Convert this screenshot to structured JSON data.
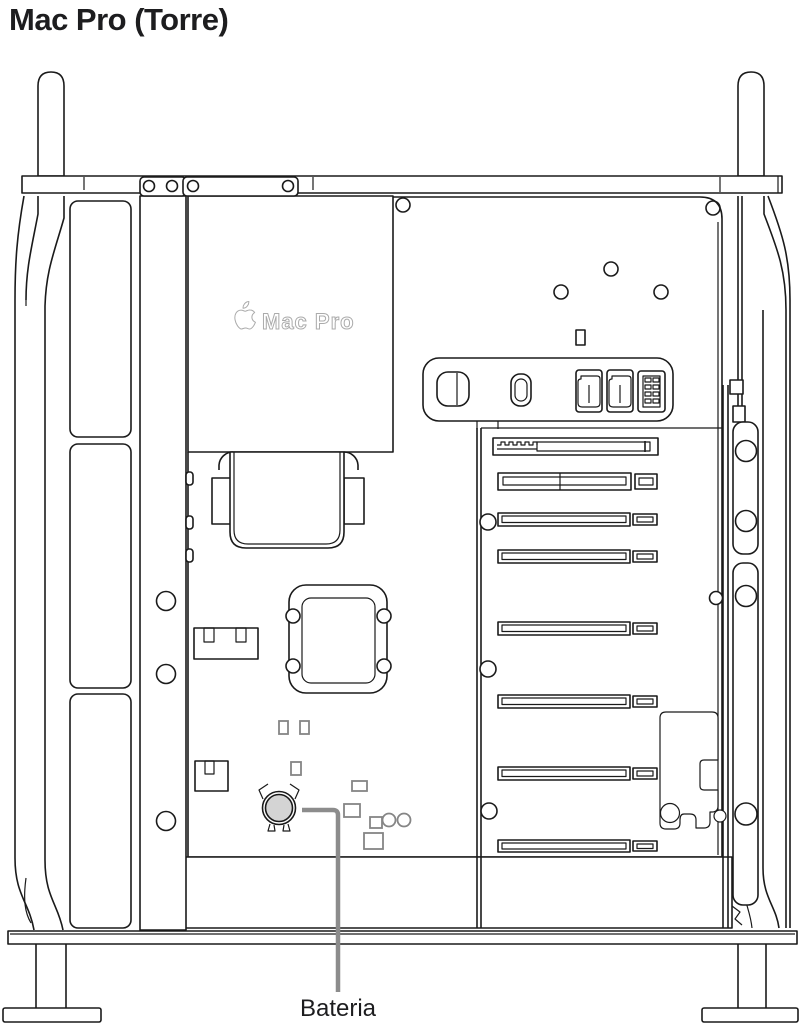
{
  "title": "Mac Pro (Torre)",
  "illustration": {
    "description": "Side view of an open Mac Pro tower showing internal components",
    "device_label": "Mac Pro",
    "callout": {
      "label": "Bateria",
      "target": "coin-cell-battery"
    }
  },
  "icons": {
    "apple_logo": "apple-logo-icon"
  },
  "colors": {
    "background": "#ffffff",
    "line_art": "#1a1a1a",
    "component_gray": "#858585",
    "logo_outline": "#ababab",
    "battery_fill": "#d4d4d4",
    "callout_line": "#8c8c8c",
    "text": "#1d1d1f"
  }
}
